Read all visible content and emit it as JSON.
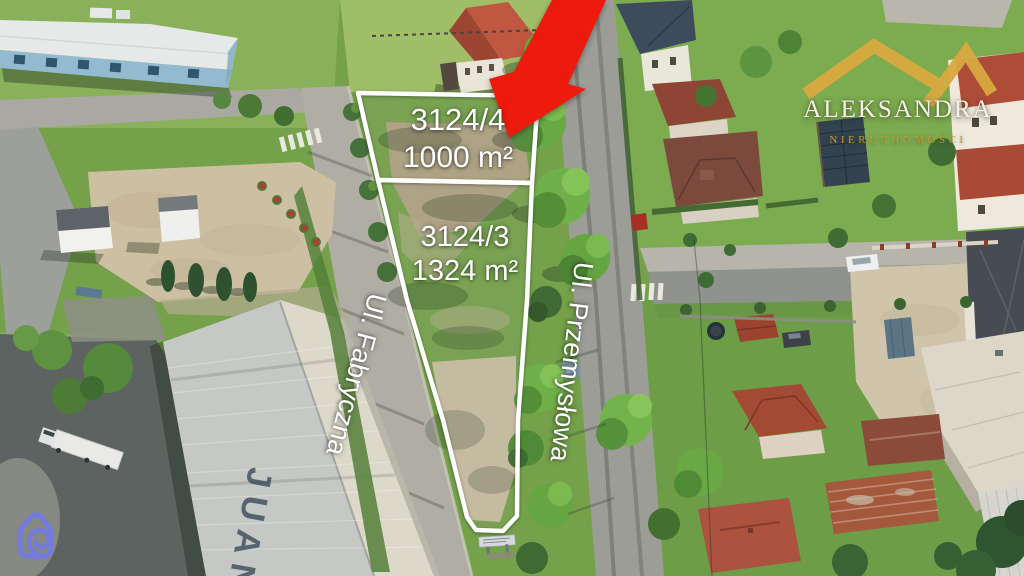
{
  "overlay": {
    "plots": [
      {
        "id": "3124/4",
        "area": "1000 m²"
      },
      {
        "id": "3124/3",
        "area": "1324 m²"
      }
    ],
    "streets": [
      {
        "name": "Ul. Fabryczna"
      },
      {
        "name": "Ul. Przemysłowa"
      }
    ]
  },
  "branding": {
    "name": "ALEKSANDRA",
    "tagline": "NIERUCHOMOŚCI",
    "roof_color": "#d9a93f",
    "name_color": "#f5f1e6",
    "tagline_color": "#c9992e"
  },
  "photo": {
    "roof_shadow_text": "JUAN"
  },
  "colors": {
    "arrow": "#ec1b0d",
    "plot_boundary": "#ffffff",
    "watermark": "#737ce2"
  }
}
